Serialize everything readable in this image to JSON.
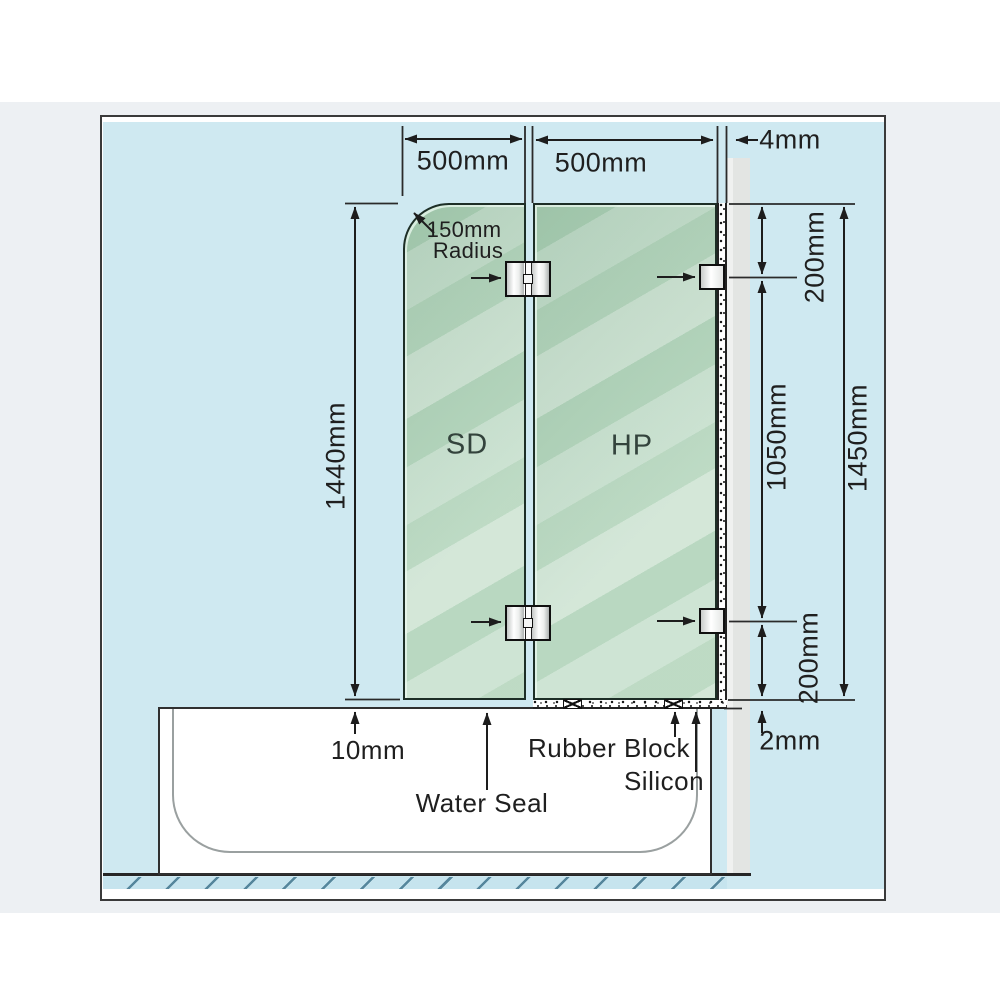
{
  "diagram": {
    "panels": {
      "left_label": "SD",
      "right_label": "HP"
    },
    "dims": {
      "left_panel_width": "500mm",
      "right_panel_width": "500mm",
      "wall_gap": "4mm",
      "corner_radius_line1": "150mm",
      "corner_radius_line2": "Radius",
      "left_panel_height": "1440mm",
      "top_hinge_offset": "200mm",
      "hinge_spacing": "1050mm",
      "right_panel_height": "1450mm",
      "bottom_hinge_offset": "200mm",
      "bath_gap": "10mm",
      "base_gap": "2mm"
    },
    "annotations": {
      "water_seal": "Water Seal",
      "rubber_block": "Rubber Block",
      "silicon": "Silicon"
    },
    "colors": {
      "page_band": "#edf0f3",
      "canvas_blue": "#cfe9f1",
      "glass_green": "#aed2b7",
      "glass_light": "#cde7d3",
      "wall_gray": "#e3e5e3",
      "line": "#1f1f1f",
      "hatch_line": "#55869c"
    }
  }
}
